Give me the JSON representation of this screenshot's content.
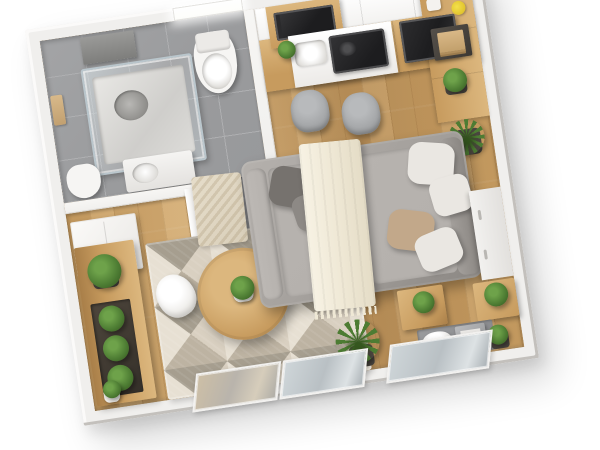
{
  "scene": {
    "kind": "3D isometric floor plan rendering",
    "subject": "studio apartment",
    "view": "rotated top-down, white background",
    "rotation_deg": -8.5,
    "rooms": [
      {
        "name": "bathroom",
        "position": "top-left",
        "floor": "gray ceramic tile",
        "items": [
          "glass shower cabin",
          "wall shelf unit",
          "hanging towels",
          "toilet",
          "compact toilet",
          "vanity with basin",
          "bright window",
          "dark tile entry walkway",
          "sliding door panels"
        ]
      },
      {
        "name": "kitchen",
        "position": "top-right",
        "items": [
          "white upper cabinets",
          "oak base cabinets",
          "built-in microwave oven",
          "black glass cooktop",
          "white sink",
          "flat-screen tv",
          "breakfast counter",
          "gray bar stool",
          "gray bar stool",
          "dark serving tray with books",
          "white jar",
          "yellow flowers",
          "potted plant"
        ]
      },
      {
        "name": "living-sleeping-area",
        "position": "center-right",
        "items": [
          "gray corner sofa bed",
          "dark gray cushion",
          "gray cushion",
          "white cushion",
          "white cushion",
          "beige cushion",
          "white cushion",
          "cream throw blanket with fringe",
          "small beige accent rug",
          "potted plant"
        ]
      },
      {
        "name": "lounge",
        "position": "center-left",
        "items": [
          "geometric triangle area rug",
          "round oak coffee table",
          "table plant in white pot",
          "white shell chair",
          "oak sideboard planter bench",
          "boxwood ball",
          "boxwood ball",
          "boxwood ball",
          "potted boxwood",
          "small plant in white pot",
          "white wardrobe"
        ]
      },
      {
        "name": "workspace",
        "position": "bottom-right",
        "items": [
          "oak side table with plant",
          "oak nightstand with plant",
          "gray floor mat",
          "white chair",
          "gray desk unit",
          "small potted plant",
          "tall grass plant"
        ]
      }
    ],
    "windows": [
      "bathroom top window",
      "glazed balcony panel warm reflection",
      "glazed balcony panel cool reflection",
      "glazed balcony panel cool reflection"
    ],
    "counts": {
      "bar_stools": 2,
      "sofa_cushions": 6,
      "boxwood_balls": 4,
      "potted_plants": 9,
      "toilets": 2
    }
  },
  "colors": {
    "background": "#ffffff",
    "wall_top": "#f0efed",
    "wall_face": "#dbd8d4",
    "wall_shadow": "#c3c0bc",
    "tile": "#9a9b9d",
    "tile_grout": "#aeafb1",
    "hall_tile": "#77787b",
    "wood": "#c89e63",
    "wood_light": "#d7b27c",
    "wood_dark": "#b8905a",
    "oak": "#c79b5e",
    "oak_light": "#dcb77e",
    "oak_dark": "#a97f49",
    "cabinet_white": "#f3f2f0",
    "appliance_black": "#1d1d1f",
    "sofa": "#a39f9b",
    "sofa_light": "#b5b1ad",
    "sofa_dark": "#8b8783",
    "pillow_dark": "#76726e",
    "pillow_gray": "#8d8985",
    "pillow_white": "#eae7e2",
    "pillow_beige": "#c2a88a",
    "blanket": "#efe8d5",
    "rug_a": "#d9d0c1",
    "rug_b": "#bdb3a2",
    "rug_c": "#e7e0d3",
    "rug_d": "#a69e8f",
    "small_rug": "#d9cfba",
    "plant": "#4d7c33",
    "plant_light": "#6ea24a",
    "plant_dark": "#35571f",
    "planter": "#4a453f",
    "chair_gray": "#a0a2a4",
    "glass": "#cfd6d9",
    "window_glow": "#fdfdfa"
  }
}
